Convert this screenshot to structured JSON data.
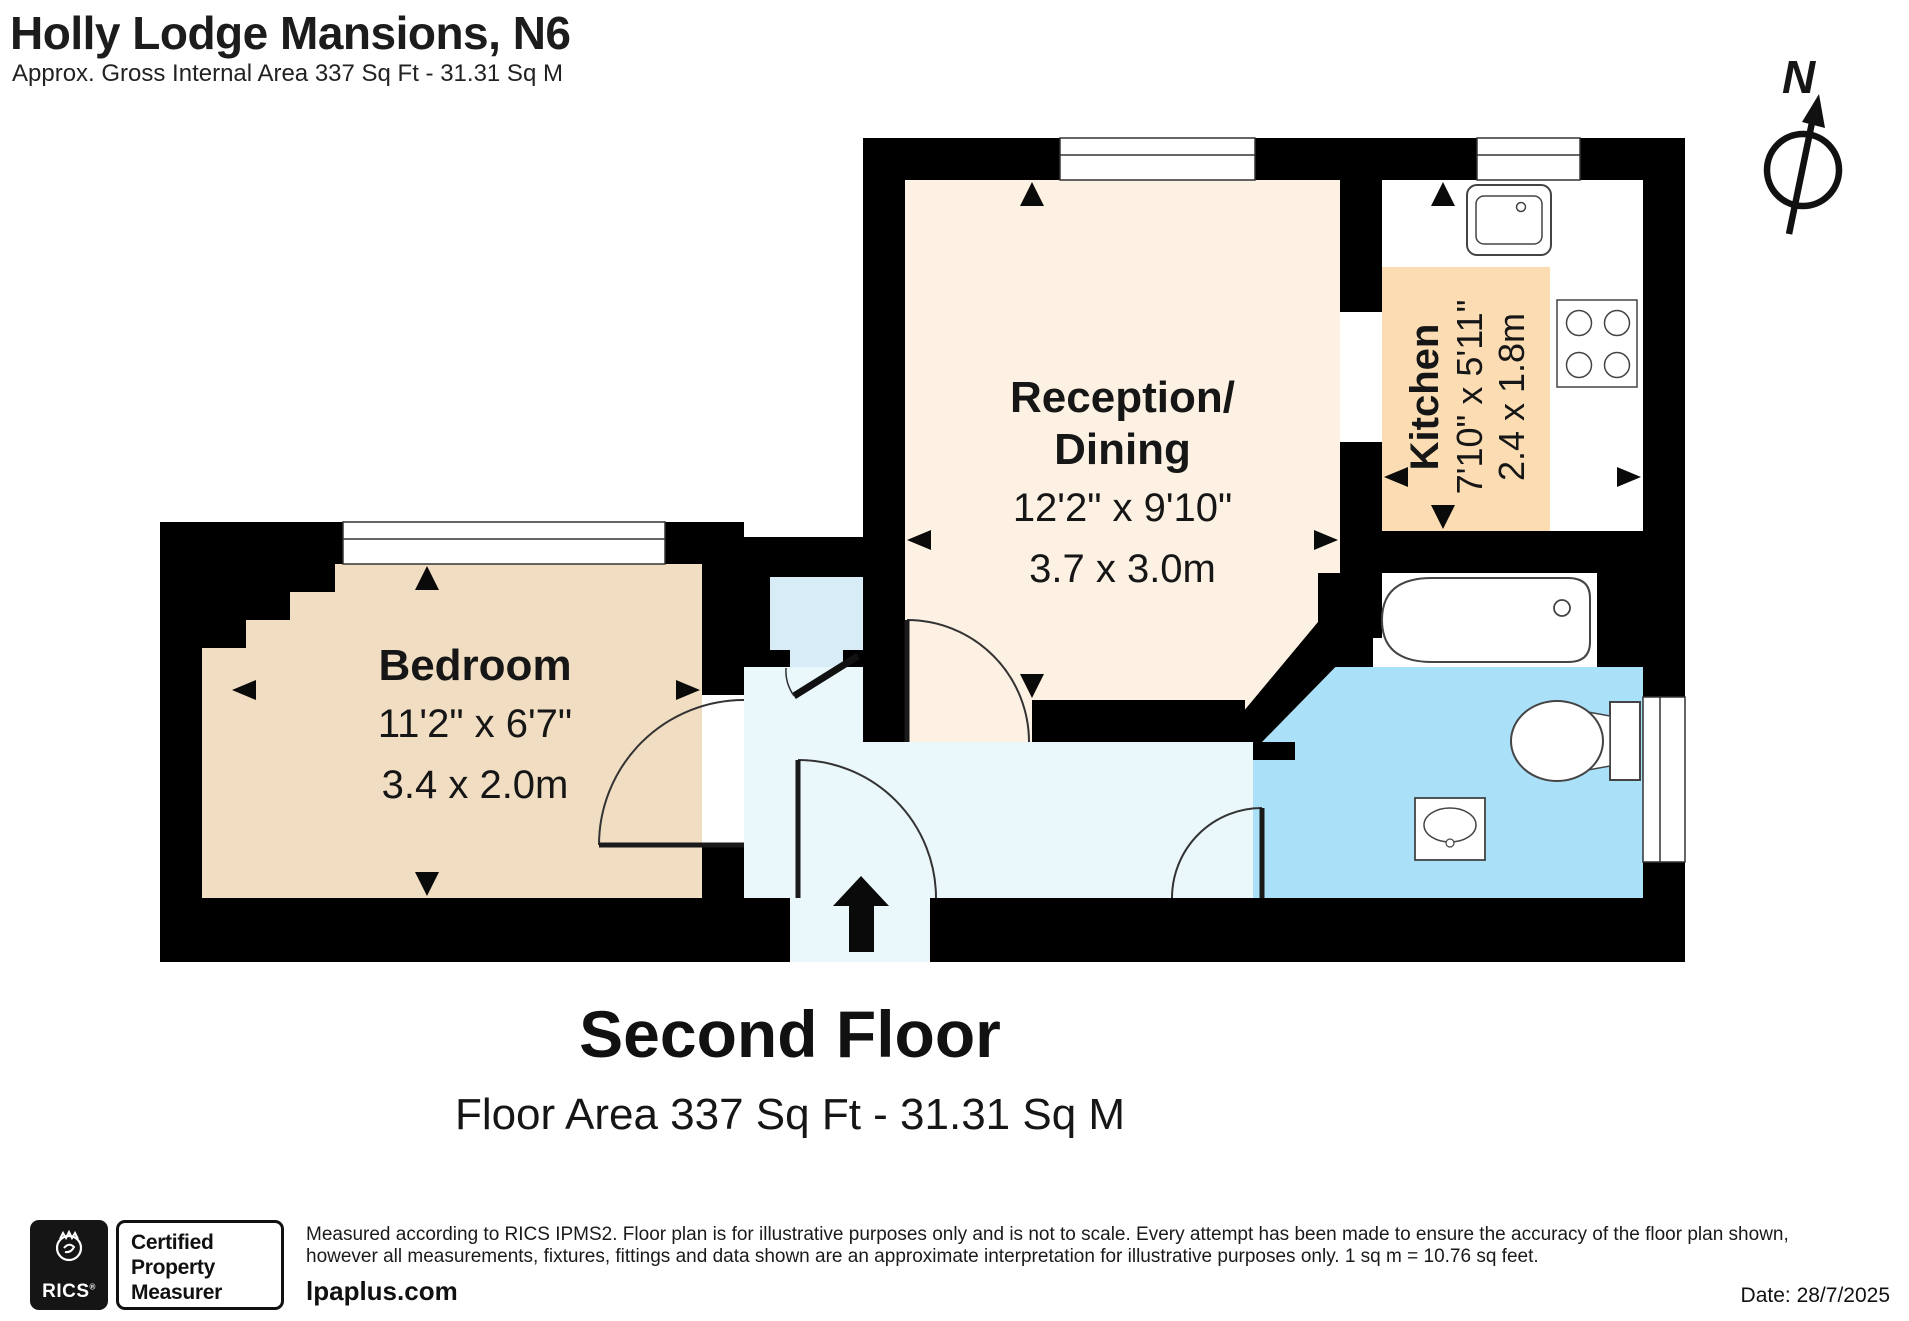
{
  "title": "Holly Lodge Mansions, N6",
  "subtitle": "Approx. Gross Internal Area 337 Sq Ft - 31.31 Sq M",
  "compass": {
    "label": "N"
  },
  "rooms": {
    "reception": {
      "name1": "Reception/",
      "name2": "Dining",
      "imperial": "12'2\" x 9'10\"",
      "metric": "3.7 x 3.0m"
    },
    "kitchen": {
      "name": "Kitchen",
      "imperial": "7'10\" x 5'11\"",
      "metric": "2.4 x 1.8m"
    },
    "bedroom": {
      "name": "Bedroom",
      "imperial": "11'2\" x 6'7\"",
      "metric": "3.4 x 2.0m"
    }
  },
  "floor": {
    "heading": "Second Floor",
    "area_line": "Floor Area 337 Sq Ft - 31.31 Sq M"
  },
  "footer": {
    "rics_label": "RICS",
    "rics_reg": "®",
    "certified": [
      "Certified",
      "Property",
      "Measurer"
    ],
    "disclaimer_line1": "Measured according to RICS IPMS2. Floor plan is for illustrative purposes only and is not to scale. Every attempt has been made to ensure the accuracy of the floor plan shown,",
    "disclaimer_line2": "however all measurements, fixtures, fittings and data shown are an approximate interpretation for illustrative purposes only. 1 sq m = 10.76 sq feet.",
    "website": "lpaplus.com",
    "date": "Date: 28/7/2025"
  },
  "colors": {
    "wall": "#000000",
    "reception_floor": "#FCF1E2",
    "bedroom_floor": "#F0DDC2",
    "kitchen_counter": "#FBDCB3",
    "bathroom_floor": "#AAE1F8",
    "hallway_floor": "#EAF7FB",
    "closet_floor": "#D8ECF7"
  }
}
